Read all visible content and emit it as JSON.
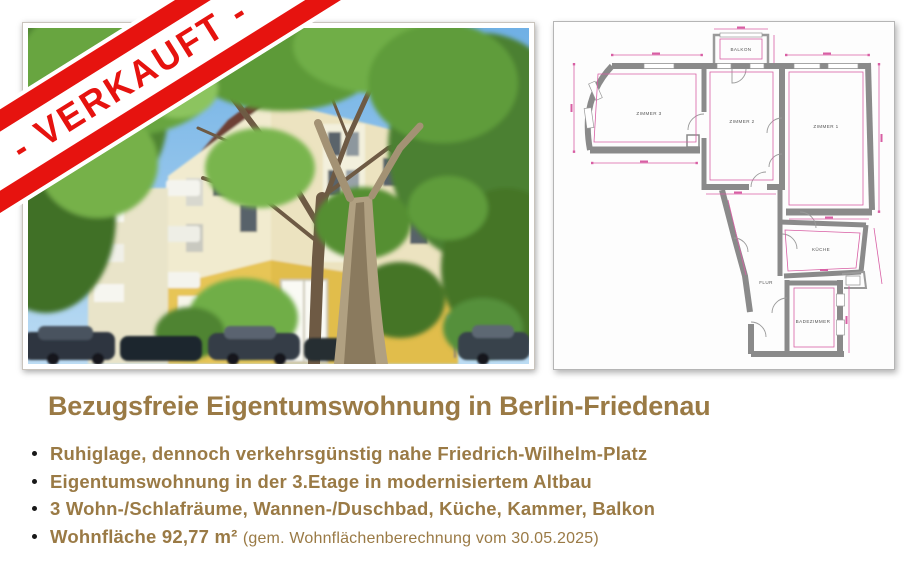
{
  "banner": {
    "label": "- VERKAUFT -",
    "red": "#e6130f"
  },
  "photo": {
    "colors": {
      "sky": "#8fc3ea",
      "foliage": "#5d9a38",
      "facade_upper": "#f1ebcf",
      "facade_lower": "#e7c557"
    }
  },
  "floorplan": {
    "wall_color": "#8a8a8a",
    "dimension_color": "#d85fa4",
    "room_labels": {
      "balkon": "BALKON",
      "zimmer3": "ZIMMER 3",
      "zimmer2": "ZIMMER 2",
      "zimmer1": "ZIMMER 1",
      "kueche": "KÜCHE",
      "flur": "FLUR",
      "badezimmer": "BADEZIMMER"
    }
  },
  "heading": {
    "text": "Bezugsfreie Eigentumswohnung in Berlin-Friedenau",
    "color": "#9a7a45"
  },
  "bullets": {
    "item1": "Ruhiglage, dennoch verkehrsgünstig nahe Friedrich-Wilhelm-Platz",
    "item2": "Eigentumswohnung in der 3.Etage in modernisiertem Altbau",
    "item3": "3 Wohn-/Schlafräume, Wannen-/Duschbad, Küche, Kammer, Balkon",
    "item4_main": "Wohnfläche 92,77 m²",
    "item4_note": "(gem. Wohnflächenberechnung vom 30.05.2025)"
  }
}
